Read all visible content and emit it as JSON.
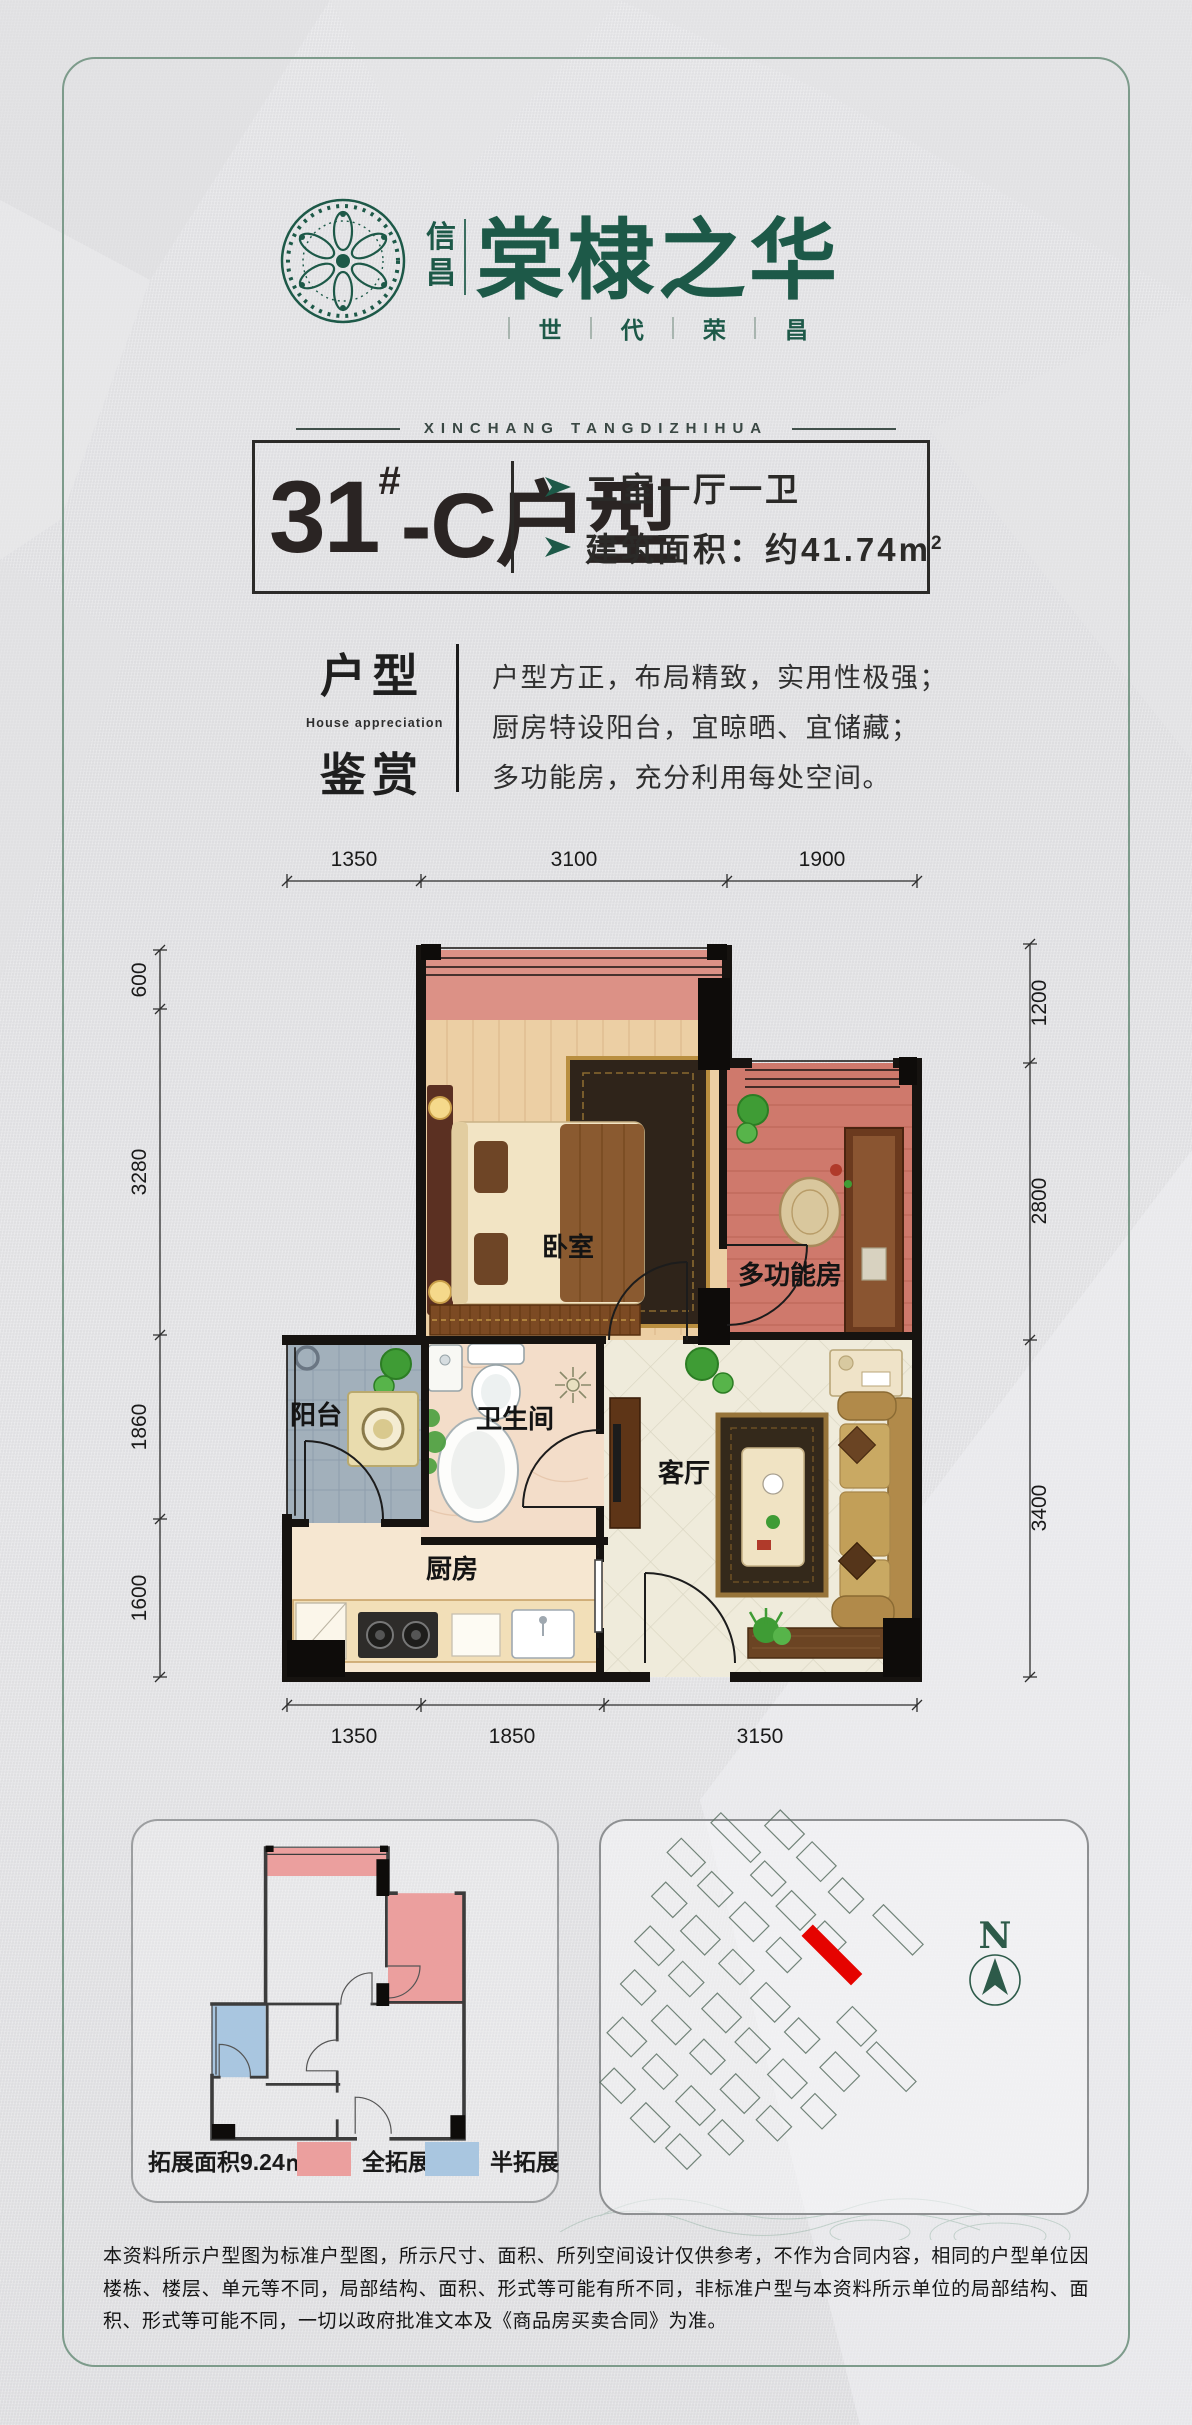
{
  "brand": {
    "prefix_chars": [
      "信",
      "昌"
    ],
    "name": "棠棣之华",
    "tagline_chars": [
      "世",
      "代",
      "荣",
      "昌"
    ],
    "romanized": "XINCHANG TANGDIZHIHUA"
  },
  "unit_title": {
    "number": "31",
    "superscript": "#",
    "suffix": "-C户型",
    "bullet1": "二室一厅一卫",
    "bullet2": "建筑面积：约41.74m",
    "bullet2_sup": "2"
  },
  "appreciation": {
    "title_top": "户型",
    "title_en": "House appreciation",
    "title_bottom": "鉴赏",
    "lines": [
      "户型方正，布局精致，实用性极强；",
      "厨房特设阳台，宜晾晒、宜储藏；",
      "多功能房，充分利用每处空间。"
    ]
  },
  "floorplan": {
    "rooms": {
      "bedroom": "卧室",
      "multi": "多功能房",
      "balcony": "阳台",
      "bath": "卫生间",
      "living": "客厅",
      "kitchen": "厨房"
    },
    "dims_top": [
      "1350",
      "3100",
      "1900"
    ],
    "dims_bottom": [
      "1350",
      "1850",
      "3150"
    ],
    "dims_left": [
      "600",
      "3280",
      "1860",
      "1600"
    ],
    "dims_right": [
      "1200",
      "2800",
      "3400"
    ]
  },
  "expansion": {
    "area_label": "拓展面积9.24㎡",
    "full_label": "全拓展",
    "half_label": "半拓展"
  },
  "sitemap": {
    "north": "N"
  },
  "disclaimer": "本资料所示户型图为标准户型图，所示尺寸、面积、所列空间设计仅供参考，不作为合同内容，相同的户型单位因楼栋、楼层、单元等不同，局部结构、面积、形式等可能有所不同，非标准户型与本资料所示单位的局部结构、面积、形式等可能不同，一切以政府批准文本及《商品房买卖合同》为准。",
  "colors": {
    "brand_green": "#1d5948",
    "frame_green": "#7d9b8b",
    "accent_red": "#e50300",
    "expansion_full": "#eb9f9e",
    "expansion_half": "#a9c6e0",
    "wall_black": "#141210"
  }
}
